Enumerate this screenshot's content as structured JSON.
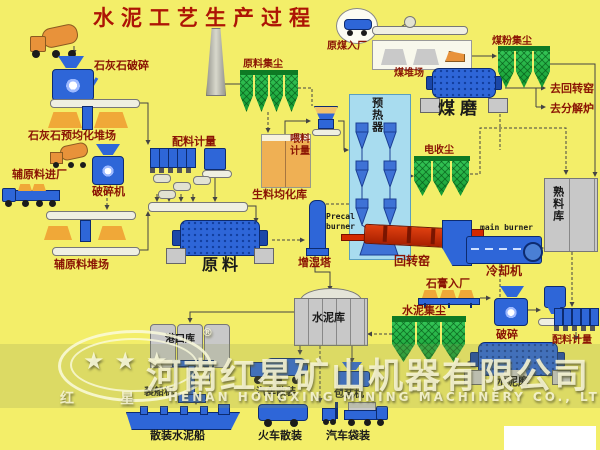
{
  "title": "水泥工艺生产过程",
  "colors": {
    "background": "#F3EE69",
    "label_red": "#8A1404",
    "label_black": "#1A1A1A",
    "equipment_blue": "#2E66D8",
    "collector_green": "#149A32",
    "kiln_red": "#D32900",
    "pile_orange": "#F0A838",
    "silo_gray": "#C8C8C8"
  },
  "sections": {
    "limestone": {
      "crusher": "石灰石破碎",
      "yard": "石灰石预均化堆场"
    },
    "auxiliary": {
      "entry": "辅原料进厂",
      "crusher": "破碎机",
      "yard": "辅原料堆场"
    },
    "raw_material": {
      "batching": "配料计量",
      "dust_collector": "原料集尘",
      "mill": "原料",
      "homogenization_silo": "生料均化库",
      "feed_metering": "喂料计量"
    },
    "coal": {
      "entry": "原煤入厂",
      "yard": "煤堆场",
      "dust_collector": "煤粉集尘",
      "mill": "煤磨",
      "to_rotary_kiln": "去回转窑",
      "to_calciner": "去分解炉"
    },
    "pyroprocess": {
      "preheater": "预热器",
      "precal_burner": "Precal burner",
      "humidifier_tower": "增湿塔",
      "esp": "电收尘",
      "rotary_kiln": "回转窑",
      "main_burner": "main burner",
      "cooler": "冷却机",
      "clinker_silo": "熟料库"
    },
    "cement": {
      "gypsum_entry": "石膏入厂",
      "crusher": "破碎",
      "batching": "配料计量",
      "dust_collector": "水泥集尘",
      "mill": "水泥磨",
      "silo": "水泥库"
    },
    "shipping": {
      "port_silo": "港口库",
      "ship_loader": "装船机",
      "bulk_ship": "散装水泥船",
      "truck_bulk": "汽车散装",
      "packer": "包装机",
      "train_bulk": "火车散装",
      "truck_bag": "汽车袋装"
    }
  },
  "watermark": {
    "company_cn": "河南红星矿山机器有限公司",
    "company_en": "HENAN HONGXING MINING MACHINERY CO., LTD",
    "logo_left": "红",
    "logo_right": "星",
    "stars": "★★★",
    "registered": "®"
  }
}
